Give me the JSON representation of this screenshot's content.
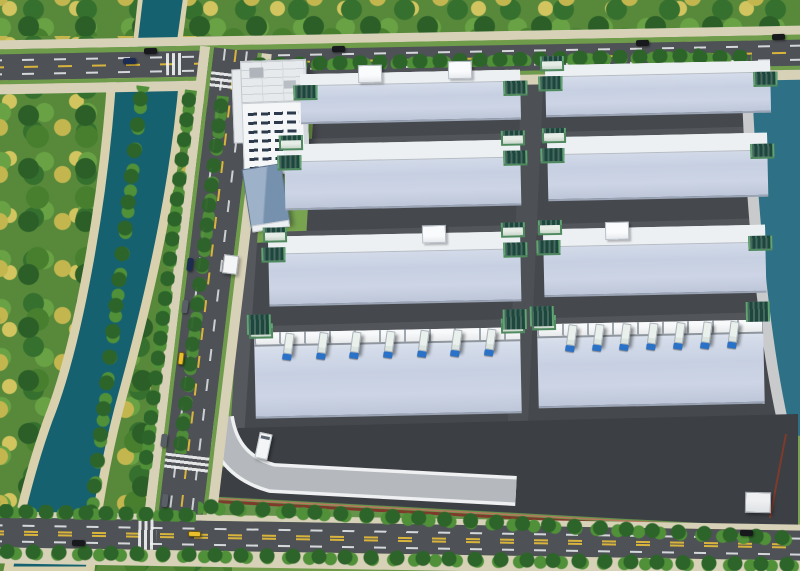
{
  "meta": {
    "description": "Aerial bird's-eye 3D architectural rendering of a logistics industrial park with eight large warehouse buildings, an office tower, a tree-lined river canal, perimeter roads and a lake",
    "view": "oblique aerial",
    "no_visible_text": true
  },
  "colors": {
    "grass": "#7aa24e",
    "forest_dark": "#2c5f28",
    "forest_mid": "#477f2f",
    "foliage_yellow": "#d2c45e",
    "water_river": "#15616f",
    "water_lake": "#2e7186",
    "river_bank": "#d9d0ad",
    "road_asphalt": "#4e5156",
    "road_sidewalk": "#d7d1b8",
    "road_verge": "#6f9c4a",
    "marking_yellow": "#d9b43c",
    "marking_white": "#eceff1",
    "campus_ground": "#45484d",
    "campus_apron": "#3c3f44",
    "internal_road": "#55585d",
    "roof_base": "#c7d0e2",
    "roof_vent": "#212b38",
    "facade_white": "#edf0f3",
    "tower_glass_green": "#1d473c",
    "tower_trim": "#4e8a5e",
    "canopy_white": "#f4f6f7",
    "truck_cab_blue": "#2a72c8",
    "truck_trailer": "#eaf0ec",
    "ramp_gray": "#b5b8bc",
    "ramp_edge": "#eef0f2",
    "fence_red": "#7e3b2c",
    "office_white": "#f4f6f8",
    "util_roof_blue": "#7691ad",
    "lawn_green": "#6f9c4a",
    "taxi_yellow": "#e9bf2e"
  },
  "scene": {
    "counts": {
      "warehouse_buildings": 8,
      "warehouse_rows": 4,
      "warehouse_columns": 2,
      "office_towers": 1,
      "utility_buildings": 1,
      "gatehouses": 2,
      "dock_trucks": [
        7,
        7
      ]
    },
    "vehicles": [
      {
        "type": "car",
        "color": "black",
        "road": "top"
      },
      {
        "type": "car",
        "color": "navy",
        "road": "top"
      },
      {
        "type": "car",
        "color": "black",
        "road": "top"
      },
      {
        "type": "car",
        "color": "black",
        "road": "top"
      },
      {
        "type": "car",
        "color": "black",
        "road": "top"
      },
      {
        "type": "car",
        "color": "navy",
        "road": "left"
      },
      {
        "type": "car",
        "color": "gray",
        "road": "left"
      },
      {
        "type": "taxi",
        "color": "yellow",
        "road": "left"
      },
      {
        "type": "car",
        "color": "gray",
        "road": "left"
      },
      {
        "type": "car",
        "color": "gray",
        "road": "left"
      },
      {
        "type": "taxi",
        "color": "yellow",
        "road": "bottom"
      },
      {
        "type": "car",
        "color": "black",
        "road": "bottom"
      },
      {
        "type": "car",
        "color": "black",
        "road": "bottom"
      },
      {
        "type": "box-truck",
        "color": "white",
        "road": "campus"
      }
    ],
    "features": [
      "river canal with tree belts",
      "lake on east side",
      "tree-lined boulevards",
      "curved access ramp",
      "loading docks with trucks",
      "red perimeter fence",
      "green glass stair towers",
      "rooftop skylight rows"
    ]
  }
}
